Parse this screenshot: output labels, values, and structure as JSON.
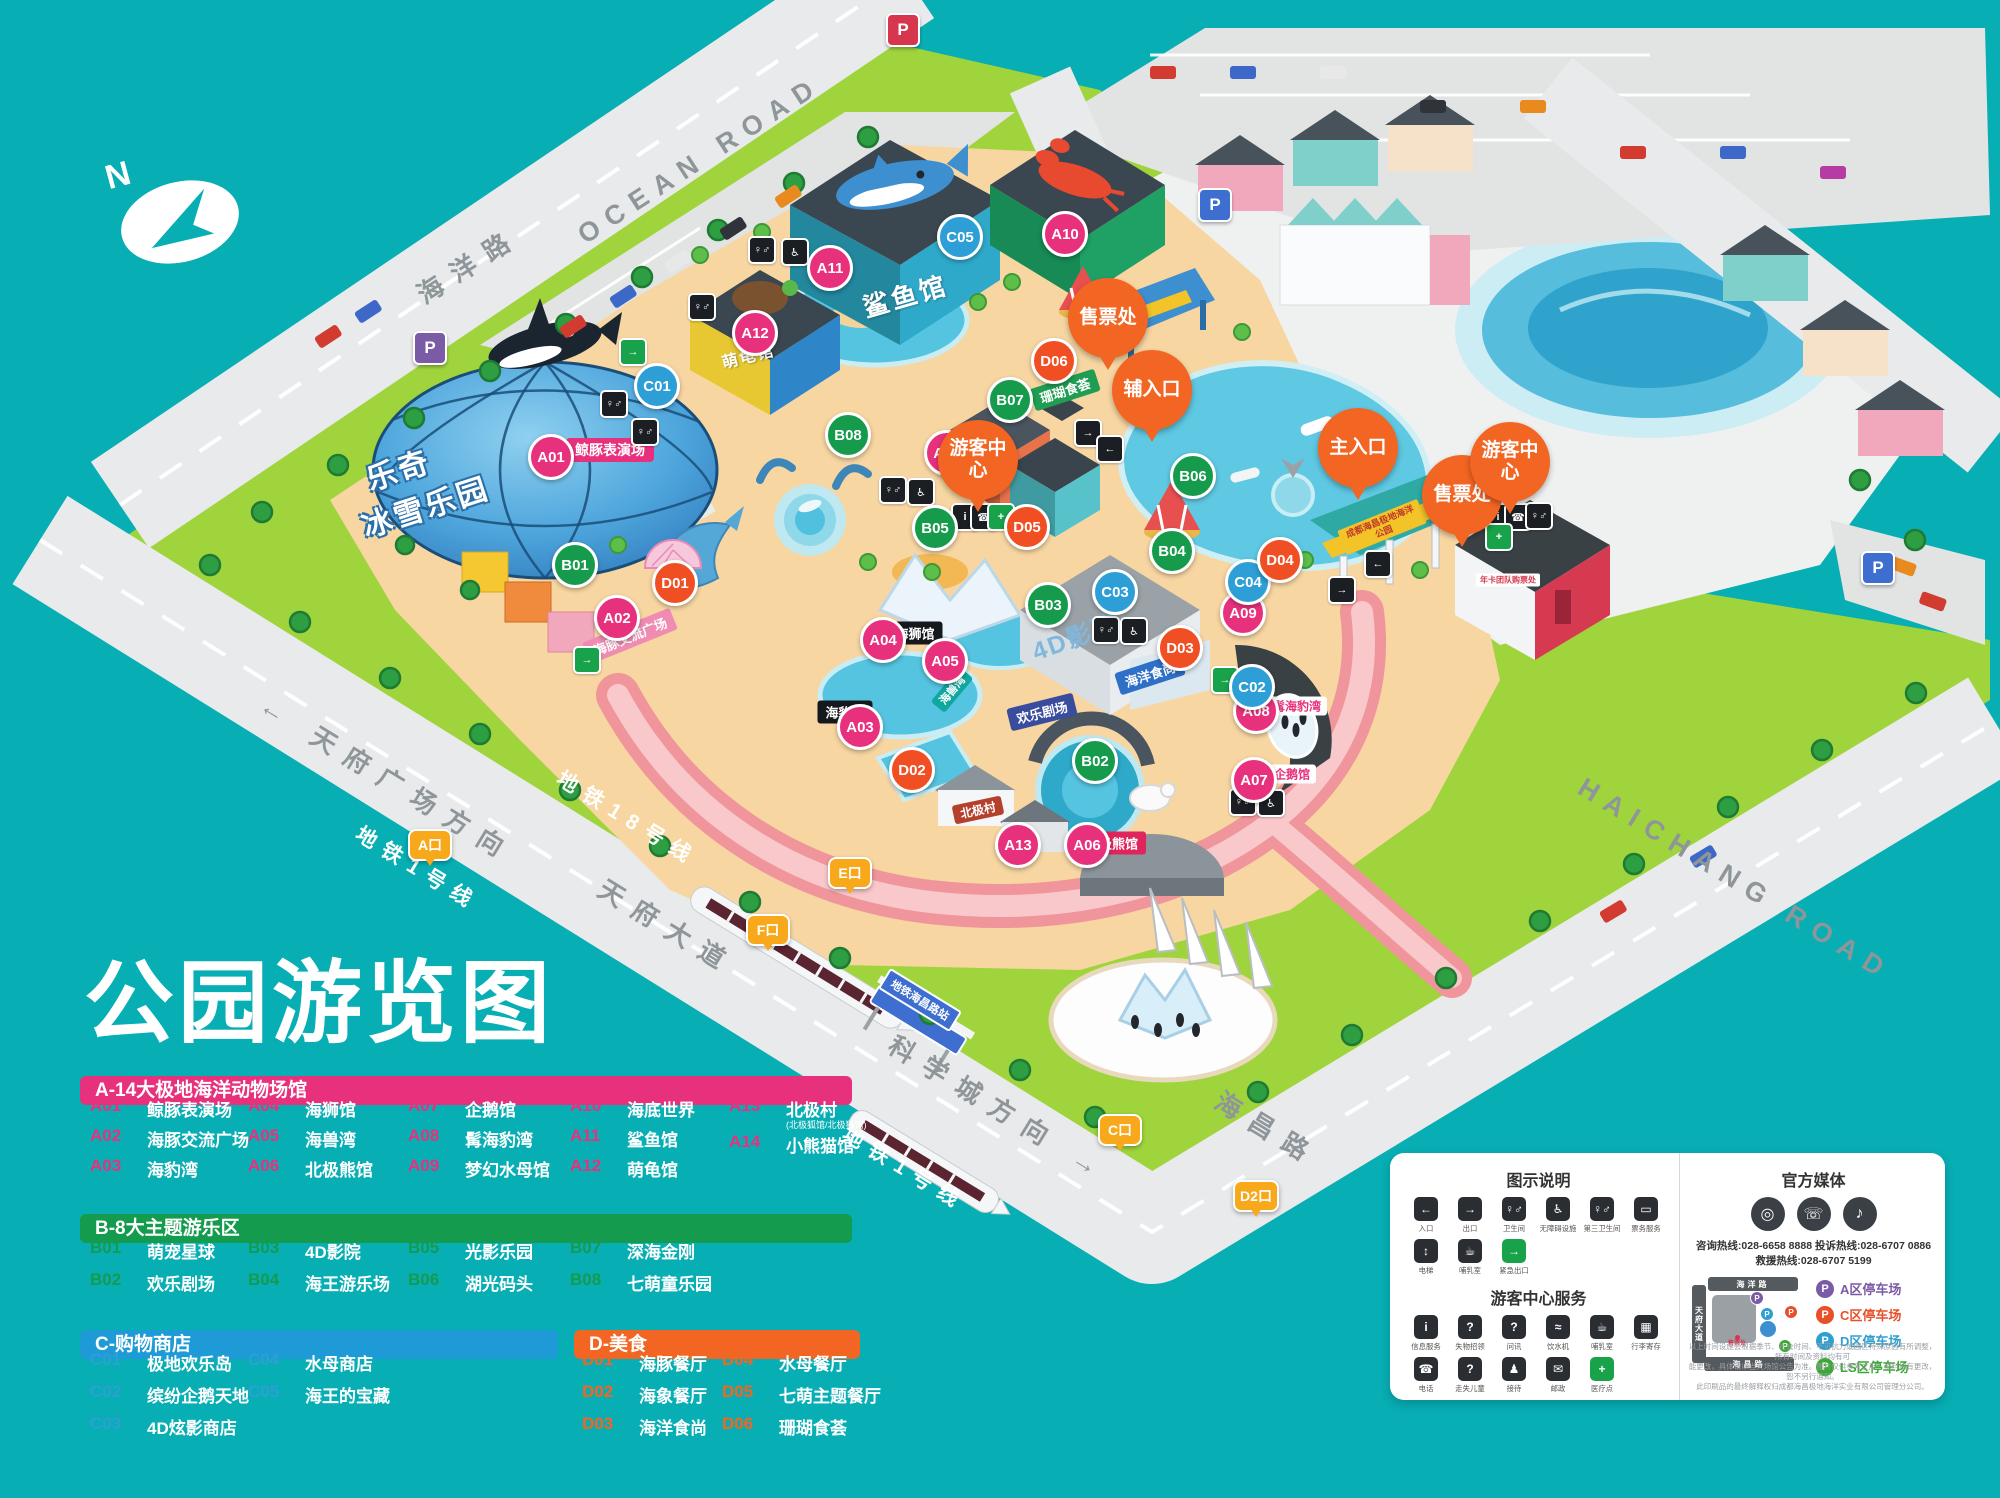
{
  "title": "公园游览图",
  "compass_label": "N",
  "road_labels": [
    {
      "text": "OCEAN ROAD",
      "x": 700,
      "y": 160,
      "rot": -33,
      "cls": "road-en"
    },
    {
      "text": "海洋路",
      "x": 468,
      "y": 264,
      "rot": -33,
      "cls": "road-cn"
    },
    {
      "text": "HAICHANG ROAD",
      "x": 1735,
      "y": 880,
      "rot": 31.5,
      "cls": "road-en"
    },
    {
      "text": "海昌路",
      "x": 1268,
      "y": 1128,
      "rot": 31.5,
      "cls": "road-cn"
    },
    {
      "text": "← 天府广场方向",
      "x": 388,
      "y": 778,
      "rot": 31.5,
      "cls": "road-cn"
    },
    {
      "text": "地铁1号线",
      "x": 418,
      "y": 868,
      "rot": 31.5,
      "cls": "metro-label"
    },
    {
      "text": "地铁18号线",
      "x": 628,
      "y": 818,
      "rot": 31.5,
      "cls": "metro-label"
    },
    {
      "text": "天府大道",
      "x": 668,
      "y": 926,
      "rot": 31.5,
      "cls": "road-cn"
    },
    {
      "text": "科学城方向 →",
      "x": 1000,
      "y": 1108,
      "rot": 31.5,
      "cls": "road-cn"
    },
    {
      "text": "地铁1号线",
      "x": 905,
      "y": 1168,
      "rot": 31.5,
      "cls": "metro-label"
    }
  ],
  "map": {
    "markers": [
      {
        "code": "A01",
        "type": "a",
        "x": 551,
        "y": 457
      },
      {
        "code": "A02",
        "type": "a",
        "x": 617,
        "y": 618
      },
      {
        "code": "A03",
        "type": "a",
        "x": 860,
        "y": 727
      },
      {
        "code": "A04",
        "type": "a",
        "x": 883,
        "y": 640
      },
      {
        "code": "A05",
        "type": "a",
        "x": 945,
        "y": 661
      },
      {
        "code": "A06",
        "type": "a",
        "x": 1087,
        "y": 845
      },
      {
        "code": "A07",
        "type": "a",
        "x": 1254,
        "y": 780
      },
      {
        "code": "A08",
        "type": "a",
        "x": 1256,
        "y": 711
      },
      {
        "code": "A09",
        "type": "a",
        "x": 1243,
        "y": 613
      },
      {
        "code": "A10",
        "type": "a",
        "x": 1065,
        "y": 234
      },
      {
        "code": "A11",
        "type": "a",
        "x": 830,
        "y": 268
      },
      {
        "code": "A12",
        "type": "a",
        "x": 755,
        "y": 333
      },
      {
        "code": "A13",
        "type": "a",
        "x": 1018,
        "y": 845
      },
      {
        "code": "A14",
        "type": "a",
        "x": 947,
        "y": 453
      },
      {
        "code": "B01",
        "type": "b",
        "x": 575,
        "y": 565
      },
      {
        "code": "B02",
        "type": "b",
        "x": 1095,
        "y": 761
      },
      {
        "code": "B03",
        "type": "b",
        "x": 1048,
        "y": 605
      },
      {
        "code": "B04",
        "type": "b",
        "x": 1172,
        "y": 551
      },
      {
        "code": "B05",
        "type": "b",
        "x": 935,
        "y": 528
      },
      {
        "code": "B06",
        "type": "b",
        "x": 1193,
        "y": 476
      },
      {
        "code": "B07",
        "type": "b",
        "x": 1010,
        "y": 400
      },
      {
        "code": "B08",
        "type": "b",
        "x": 848,
        "y": 435
      },
      {
        "code": "C01",
        "type": "c",
        "x": 657,
        "y": 386
      },
      {
        "code": "C02",
        "type": "c",
        "x": 1252,
        "y": 687
      },
      {
        "code": "C03",
        "type": "c",
        "x": 1115,
        "y": 592
      },
      {
        "code": "C04",
        "type": "c",
        "x": 1248,
        "y": 582
      },
      {
        "code": "C05",
        "type": "c",
        "x": 960,
        "y": 237
      },
      {
        "code": "D01",
        "type": "d",
        "x": 675,
        "y": 583
      },
      {
        "code": "D02",
        "type": "d",
        "x": 912,
        "y": 770
      },
      {
        "code": "D03",
        "type": "d",
        "x": 1180,
        "y": 648
      },
      {
        "code": "D04",
        "type": "d",
        "x": 1280,
        "y": 560
      },
      {
        "code": "D05",
        "type": "d",
        "x": 1027,
        "y": 527
      },
      {
        "code": "D06",
        "type": "d",
        "x": 1054,
        "y": 361
      }
    ],
    "balloons": [
      {
        "label": "售票处",
        "x": 1108,
        "y": 318
      },
      {
        "label": "辅入口",
        "x": 1152,
        "y": 390
      },
      {
        "label": "主入口",
        "x": 1358,
        "y": 448
      },
      {
        "label": "售票处",
        "x": 1462,
        "y": 495
      },
      {
        "label": "游客中心",
        "x": 1510,
        "y": 462
      },
      {
        "label": "游客中心",
        "x": 978,
        "y": 460
      }
    ],
    "exits": [
      {
        "label": "A口",
        "x": 430,
        "y": 845
      },
      {
        "label": "C口",
        "x": 1120,
        "y": 1130
      },
      {
        "label": "D2口",
        "x": 1256,
        "y": 1196
      },
      {
        "label": "E口",
        "x": 850,
        "y": 873
      },
      {
        "label": "F口",
        "x": 768,
        "y": 930
      }
    ],
    "facilities": [
      {
        "g": "♀♂",
        "x": 614,
        "y": 404
      },
      {
        "g": "♀♂",
        "x": 702,
        "y": 307
      },
      {
        "g": "♀♂",
        "x": 762,
        "y": 250
      },
      {
        "g": "♿",
        "x": 795,
        "y": 252
      },
      {
        "g": "♀♂",
        "x": 893,
        "y": 490
      },
      {
        "g": "♿",
        "x": 921,
        "y": 492
      },
      {
        "g": "♀♂",
        "x": 1106,
        "y": 630
      },
      {
        "g": "♿",
        "x": 1134,
        "y": 631
      },
      {
        "g": "♀♂",
        "x": 1243,
        "y": 802
      },
      {
        "g": "♿",
        "x": 1271,
        "y": 803
      },
      {
        "g": "→",
        "x": 1088,
        "y": 433
      },
      {
        "g": "←",
        "x": 1110,
        "y": 449
      },
      {
        "g": "←",
        "x": 1378,
        "y": 564
      },
      {
        "g": "→",
        "x": 1342,
        "y": 590
      },
      {
        "g": "i",
        "x": 1498,
        "y": 517
      },
      {
        "g": "☎",
        "x": 1518,
        "y": 517
      },
      {
        "g": "♀♂",
        "x": 1539,
        "y": 516
      },
      {
        "g": "+",
        "x": 1499,
        "y": 537,
        "green": 1
      },
      {
        "g": "i",
        "x": 965,
        "y": 517
      },
      {
        "g": "☎",
        "x": 984,
        "y": 517
      },
      {
        "g": "+",
        "x": 1001,
        "y": 517,
        "green": 1
      },
      {
        "g": "→",
        "x": 633,
        "y": 352,
        "green": 1
      },
      {
        "g": "→",
        "x": 587,
        "y": 660,
        "green": 1
      },
      {
        "g": "→",
        "x": 1225,
        "y": 680,
        "green": 1
      },
      {
        "g": "♀♂",
        "x": 645,
        "y": 432
      }
    ],
    "psigns": [
      {
        "x": 430,
        "y": 348,
        "c": "#7b5aa6"
      },
      {
        "x": 903,
        "y": 30,
        "c": "#d6374f"
      },
      {
        "x": 1215,
        "y": 205,
        "c": "#3e6fd0"
      },
      {
        "x": 1878,
        "y": 568,
        "c": "#3e6fd0"
      }
    ],
    "signs": [
      {
        "text": "鲸豚表演场",
        "x": 610,
        "y": 450,
        "cls": "pill-pink"
      },
      {
        "text": "鲨鱼馆",
        "x": 905,
        "y": 295,
        "rot": -16,
        "cls": "bldg-shark"
      },
      {
        "text": "萌龟馆",
        "x": 748,
        "y": 355,
        "rot": -14,
        "cls": "bldg-turtle"
      },
      {
        "text": "乐奇",
        "x": 398,
        "y": 468,
        "rot": -18,
        "cls": "dome-txt"
      },
      {
        "text": "冰雪乐园",
        "x": 425,
        "y": 505,
        "rot": -18,
        "cls": "dome-txt"
      },
      {
        "text": "海豚交流广场",
        "x": 630,
        "y": 636,
        "rot": -22,
        "cls": "pill-rose"
      },
      {
        "text": "海狮馆",
        "x": 915,
        "y": 633,
        "cls": "pill-dark"
      },
      {
        "text": "海兽湾",
        "x": 952,
        "y": 690,
        "rot": -50,
        "cls": "pill-teal"
      },
      {
        "text": "海豹湾",
        "x": 845,
        "y": 712,
        "cls": "pill-dark"
      },
      {
        "text": "4D影院",
        "x": 1075,
        "y": 636,
        "rot": -20,
        "cls": "txt-4d"
      },
      {
        "text": "海洋食尚",
        "x": 1150,
        "y": 674,
        "rot": -18,
        "cls": "pill-blue"
      },
      {
        "text": "珊瑚食荟",
        "x": 1065,
        "y": 390,
        "rot": -18,
        "cls": "pill-green"
      },
      {
        "text": "欢乐剧场",
        "x": 1042,
        "y": 712,
        "rot": -14,
        "cls": "pill-navy"
      },
      {
        "text": "北极村",
        "x": 978,
        "y": 810,
        "rot": -12,
        "cls": "pill-brown"
      },
      {
        "text": "北极熊馆",
        "x": 1112,
        "y": 843,
        "cls": "pill-crimson"
      },
      {
        "text": "企鹅馆",
        "x": 1292,
        "y": 774,
        "cls": "pill-white-pink"
      },
      {
        "text": "髯海豹湾",
        "x": 1297,
        "y": 706,
        "cls": "pill-white-pink"
      },
      {
        "text": "成都海昌极地海洋公园",
        "x": 1382,
        "y": 527,
        "rot": -22,
        "cls": "gate-sign"
      },
      {
        "text": "年卡团队购票处",
        "x": 1508,
        "y": 580,
        "cls": "ticket-sign"
      },
      {
        "text": "地铁海昌路站",
        "x": 920,
        "y": 1000,
        "rot": 31.5,
        "cls": "station-sign"
      }
    ]
  },
  "legend": {
    "a_title": "A-14大极地海洋动物场馆",
    "b_title": "B-8大主题游乐区",
    "c_title": "C-购物商店",
    "d_title": "D-美食",
    "a": [
      {
        "code": "A01",
        "name": "鲸豚表演场",
        "x": 90,
        "y": 1096
      },
      {
        "code": "A02",
        "name": "海豚交流广场",
        "x": 90,
        "y": 1126
      },
      {
        "code": "A03",
        "name": "海豹湾",
        "x": 90,
        "y": 1156
      },
      {
        "code": "A04",
        "name": "海狮馆",
        "x": 248,
        "y": 1096
      },
      {
        "code": "A05",
        "name": "海兽湾",
        "x": 248,
        "y": 1126
      },
      {
        "code": "A06",
        "name": "北极熊馆",
        "x": 248,
        "y": 1156
      },
      {
        "code": "A07",
        "name": "企鹅馆",
        "x": 408,
        "y": 1096
      },
      {
        "code": "A08",
        "name": "髯海豹湾",
        "x": 408,
        "y": 1126
      },
      {
        "code": "A09",
        "name": "梦幻水母馆",
        "x": 408,
        "y": 1156
      },
      {
        "code": "A10",
        "name": "海底世界",
        "x": 570,
        "y": 1096
      },
      {
        "code": "A11",
        "name": "鲨鱼馆",
        "x": 570,
        "y": 1126
      },
      {
        "code": "A12",
        "name": "萌龟馆",
        "x": 570,
        "y": 1156
      },
      {
        "code": "A13",
        "name": "北极村",
        "sub": "(北极狐馆/北极狼馆)",
        "x": 729,
        "y": 1096
      },
      {
        "code": "A14",
        "name": "小熊猫馆",
        "x": 729,
        "y": 1132
      }
    ],
    "b": [
      {
        "code": "B01",
        "name": "萌宠星球",
        "x": 90,
        "y": 1238
      },
      {
        "code": "B02",
        "name": "欢乐剧场",
        "x": 90,
        "y": 1270
      },
      {
        "code": "B03",
        "name": "4D影院",
        "x": 248,
        "y": 1238
      },
      {
        "code": "B04",
        "name": "海王游乐场",
        "x": 248,
        "y": 1270
      },
      {
        "code": "B05",
        "name": "光影乐园",
        "x": 408,
        "y": 1238
      },
      {
        "code": "B06",
        "name": "湖光码头",
        "x": 408,
        "y": 1270
      },
      {
        "code": "B07",
        "name": "深海金刚",
        "x": 570,
        "y": 1238
      },
      {
        "code": "B08",
        "name": "七萌童乐园",
        "x": 570,
        "y": 1270
      }
    ],
    "c": [
      {
        "code": "C01",
        "name": "极地欢乐岛",
        "x": 90,
        "y": 1350
      },
      {
        "code": "C02",
        "name": "缤纷企鹅天地",
        "x": 90,
        "y": 1382
      },
      {
        "code": "C03",
        "name": "4D炫影商店",
        "x": 90,
        "y": 1414
      },
      {
        "code": "C04",
        "name": "水母商店",
        "x": 248,
        "y": 1350
      },
      {
        "code": "C05",
        "name": "海王的宝藏",
        "x": 248,
        "y": 1382
      }
    ],
    "d": [
      {
        "code": "D01",
        "name": "海豚餐厅",
        "x": 582,
        "y": 1350
      },
      {
        "code": "D02",
        "name": "海象餐厅",
        "x": 582,
        "y": 1382
      },
      {
        "code": "D03",
        "name": "海洋食尚",
        "x": 582,
        "y": 1414
      },
      {
        "code": "D04",
        "name": "水母餐厅",
        "x": 722,
        "y": 1350
      },
      {
        "code": "D05",
        "name": "七萌主题餐厅",
        "x": 722,
        "y": 1382
      },
      {
        "code": "D06",
        "name": "珊瑚食荟",
        "x": 722,
        "y": 1414
      }
    ]
  },
  "info": {
    "legend_title": "图示说明",
    "legend_icons": [
      {
        "label": "入口",
        "glyph": "←"
      },
      {
        "label": "出口",
        "glyph": "→"
      },
      {
        "label": "卫生间",
        "glyph": "♀♂"
      },
      {
        "label": "无障碍设施",
        "glyph": "♿"
      },
      {
        "label": "第三卫生间",
        "glyph": "♀♂"
      },
      {
        "label": "票务服务",
        "glyph": "▭"
      },
      {
        "label": "电梯",
        "glyph": "↕"
      },
      {
        "label": "哺乳室",
        "glyph": "☕"
      },
      {
        "label": "紧急出口",
        "glyph": "→",
        "green": 1
      }
    ],
    "services_title": "游客中心服务",
    "service_icons": [
      {
        "label": "信息服务",
        "glyph": "i"
      },
      {
        "label": "失物招领",
        "glyph": "?"
      },
      {
        "label": "问讯",
        "glyph": "?"
      },
      {
        "label": "饮水机",
        "glyph": "≈"
      },
      {
        "label": "哺乳室",
        "glyph": "☕"
      },
      {
        "label": "行李寄存",
        "glyph": "▦"
      },
      {
        "label": "电话",
        "glyph": "☎"
      },
      {
        "label": "走失儿童",
        "glyph": "?"
      },
      {
        "label": "接待",
        "glyph": "♟"
      },
      {
        "label": "邮政",
        "glyph": "✉"
      },
      {
        "label": "医疗点",
        "glyph": "+",
        "green": 1
      }
    ],
    "media_title": "官方媒体",
    "social_icons": [
      {
        "glyph": "◎"
      },
      {
        "glyph": "☏"
      },
      {
        "glyph": "♪"
      }
    ],
    "hotline1": "咨询热线:028-6658 8888  投诉热线:028-6707 0886",
    "hotline2": "救援热线:028-6707 5199",
    "parking_p": "P",
    "minimap": {
      "top": "海洋路",
      "left": "天府大道",
      "bottom": "海昌路",
      "dot": "售票处"
    },
    "parking": [
      {
        "label": "A区停车场",
        "c": "#7b5aa6"
      },
      {
        "label": "C区停车场",
        "c": "#e8502a"
      },
      {
        "label": "D区停车场",
        "c": "#2e9fd0"
      },
      {
        "label": "LS区停车场",
        "c": "#3aa935"
      }
    ],
    "disclaimer": [
      "以上时间设施会根据季节、社会时间、不可抗力或园区特殊原因有所调整，所有时间及资料均有可",
      "能更改，具体请以当天场馆公告为准。图片仅供参考之用，资料如有更改，恕不另行通知。",
      "此印刷品的最终解释权归成都海昌极地海洋实业有限公司管理分公司。"
    ]
  }
}
